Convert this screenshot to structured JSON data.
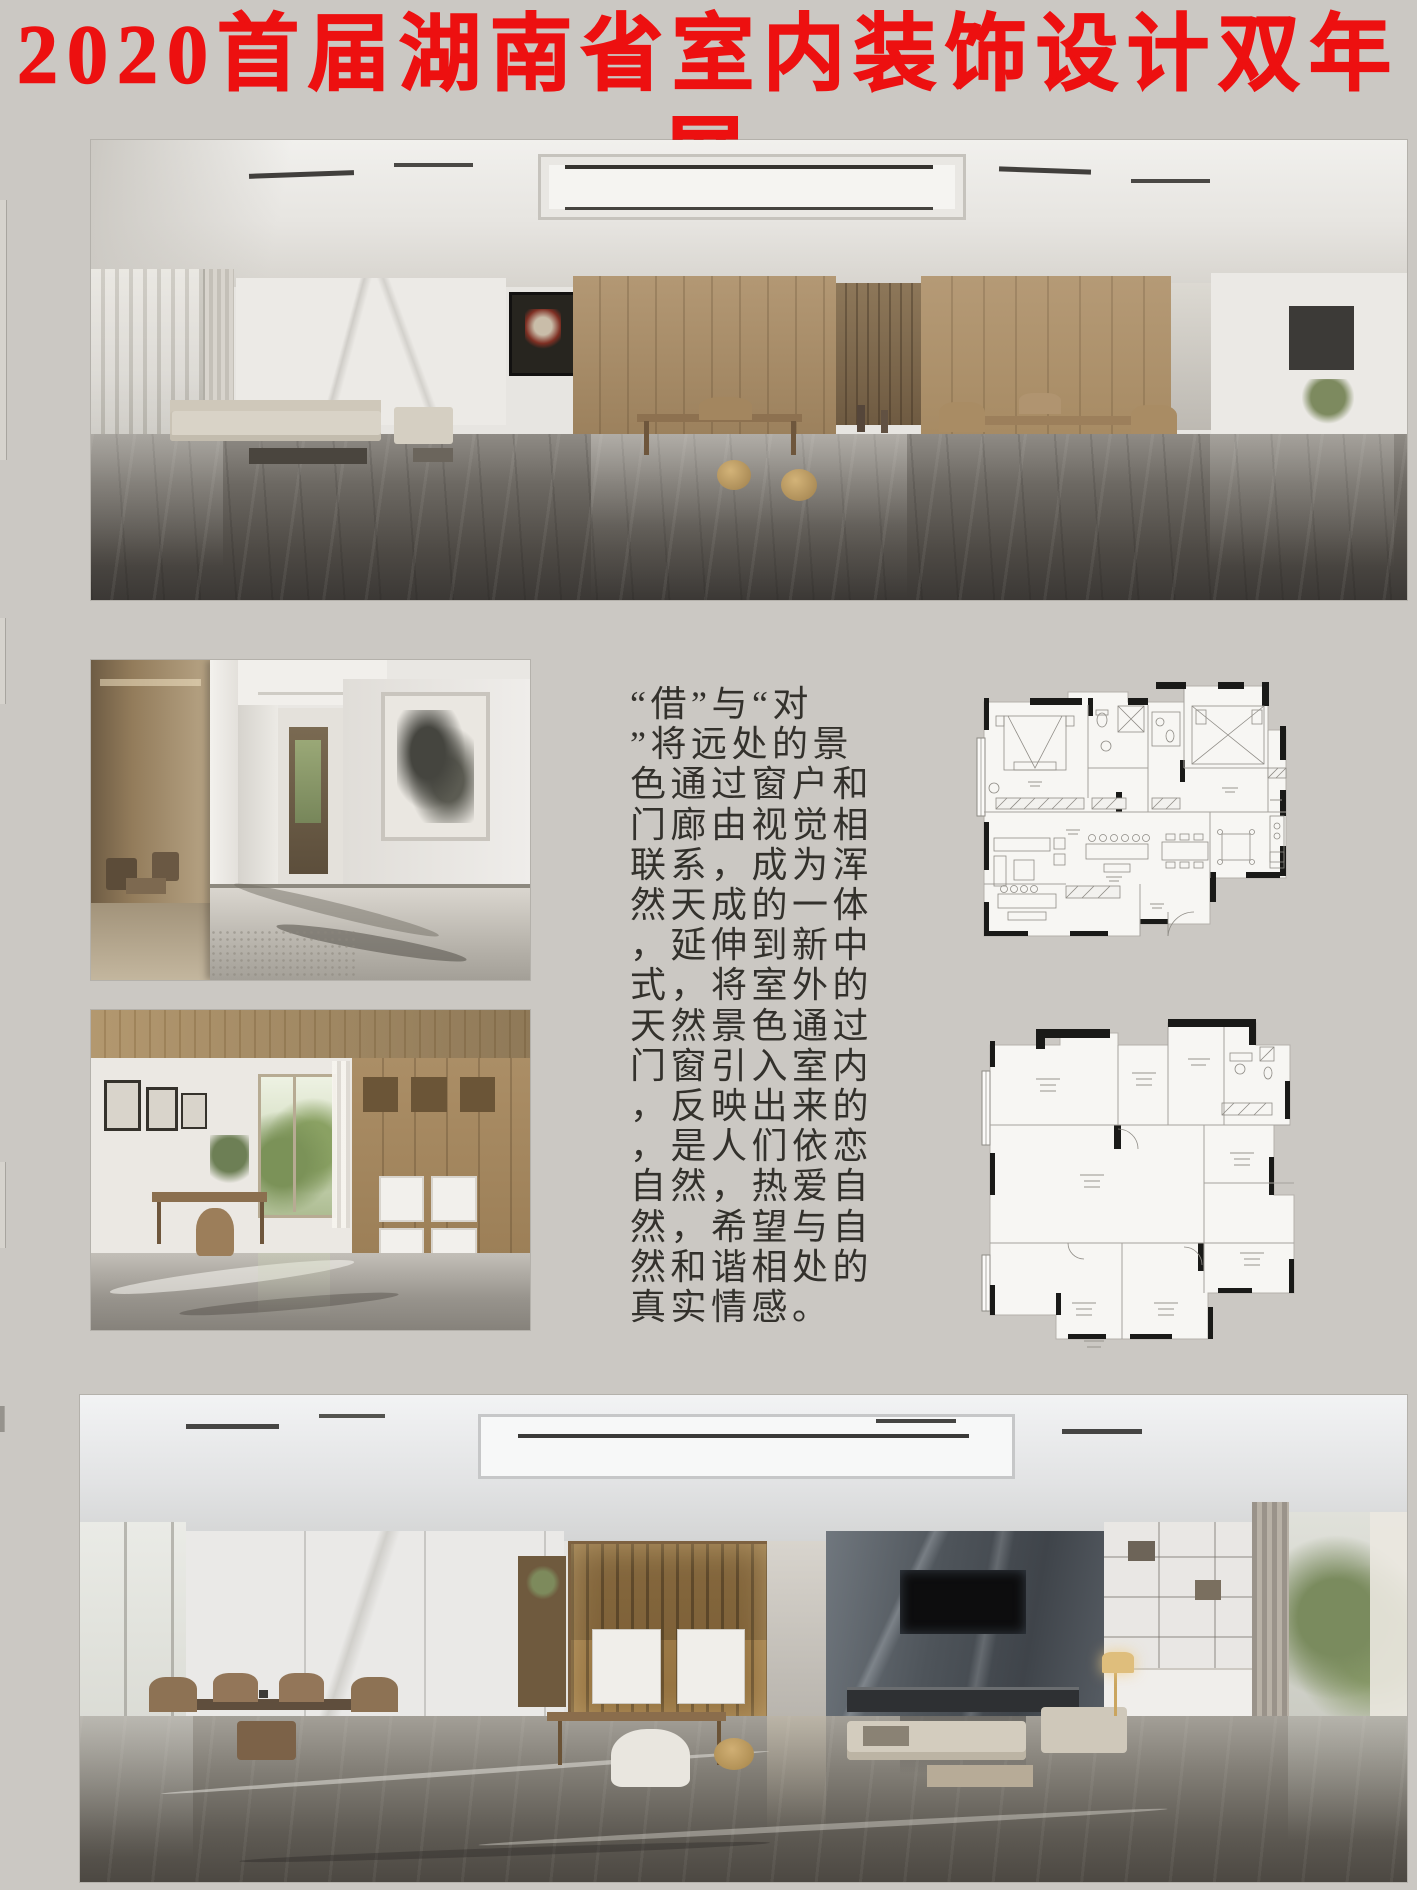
{
  "title": {
    "text": "2020首届湖南省室内装饰设计双年展",
    "color": "#ed1010"
  },
  "essay": {
    "lines": [
      "“借”与“对",
      "”将远处的景",
      "色通过窗户和",
      "门廊由视觉相",
      "联系，成为浑",
      "然天成的一体",
      "，延伸到新中",
      "式，将室外的",
      "天然景色通过",
      "门窗引入室内",
      "，反映出来的",
      "，是人们依恋",
      "自然，热爱自",
      "然，希望与自",
      "然和谐相处的",
      "真实情感。"
    ],
    "full_text": "“借”与“对”将远处的景色通过窗户和门廊由视觉相联系，成为浑然天成的一体，延伸到新中式，将室外的天然景色通过门窗引入室内，反映出来的，是人们依恋自然，热爱自然，希望与自然和谐相处的真实情感。",
    "color": "#33312c"
  },
  "colors": {
    "background": "#cbc8c3",
    "title_red": "#ed1010",
    "plan_wall": "#1a1a18",
    "plan_line": "#a5a29c",
    "plan_fill": "#f7f6f3",
    "wood": "#a98e6a",
    "floor_dark": "#3b3835"
  }
}
